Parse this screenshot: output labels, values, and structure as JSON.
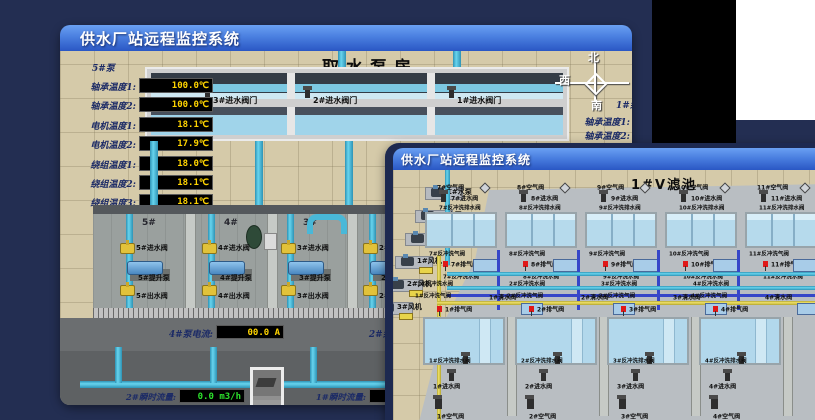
{
  "back_window": {
    "title": "供水厂站远程监控系统",
    "scene_title": "取水泵房",
    "left_panel": {
      "header": "5#泵",
      "rows": [
        {
          "label": "轴承温度1:",
          "value": "100.0℃"
        },
        {
          "label": "轴承温度2:",
          "value": "100.0℃"
        },
        {
          "label": "电机温度1:",
          "value": "18.1℃"
        },
        {
          "label": "电机温度2:",
          "value": "17.9℃"
        },
        {
          "label": "绕组温度1:",
          "value": "18.0℃"
        },
        {
          "label": "绕组温度2:",
          "value": "18.1℃"
        },
        {
          "label": "绕组温度3:",
          "value": "18.1℃"
        },
        {
          "label": "管道压力:",
          "value": "0.0007MPa"
        },
        {
          "label": "多功能阀:",
          "value": "0%"
        }
      ]
    },
    "intake_valves": [
      "3#进水阀门",
      "2#进水阀门",
      "1#进水阀门"
    ],
    "compass": {
      "north": "北",
      "west": "西",
      "south": "南"
    },
    "right_panel": {
      "header": "1#泵",
      "rows": [
        "轴承温度1:",
        "轴承温度2:"
      ]
    },
    "pump_bays": [
      {
        "bay": "5#",
        "inlet": "5#进水阀",
        "pump": "5#提升泵",
        "outlet": "5#出水阀"
      },
      {
        "bay": "4#",
        "inlet": "4#进水阀",
        "pump": "4#提升泵",
        "outlet": "4#出水阀"
      },
      {
        "bay": "3#",
        "inlet": "3#进水阀",
        "pump": "3#提升泵",
        "outlet": "3#出水阀"
      },
      {
        "bay": "2#",
        "inlet": "2#进水阀",
        "pump": "2#提升泵",
        "outlet": "2#出水阀"
      }
    ],
    "current_meters": [
      {
        "label": "4#泵电流:",
        "value": "00.0 A"
      },
      {
        "label": "2#泵电流:",
        "value": ""
      }
    ],
    "flow_meters": [
      {
        "label": "2#瞬时流量:",
        "value": "0.0 m3/h"
      },
      {
        "label": "1#瞬时流量:",
        "value": "0.0 m3/h"
      }
    ]
  },
  "front_window": {
    "title": "供水厂站远程监控系统",
    "scene_title": "1#V滤池",
    "equipment": [
      "1#水泵",
      "2#水泵",
      "3#水泵",
      "1#风机",
      "2#风机",
      "3#风机"
    ],
    "top_filters": [
      {
        "air": "7#空气阀",
        "inlet": "7#进水阀",
        "drain": "7#反冲洗排水阀",
        "bw_air": "7#反冲洗气阀",
        "exhaust": "7#排气阀",
        "bw_water": "7#反冲洗水阀"
      },
      {
        "air": "8#空气阀",
        "inlet": "8#进水阀",
        "drain": "8#反冲洗排水阀",
        "bw_air": "8#反冲洗气阀",
        "exhaust": "8#排气阀",
        "bw_water": "8#反冲洗水阀"
      },
      {
        "air": "9#空气阀",
        "inlet": "9#进水阀",
        "drain": "9#反冲洗排水阀",
        "bw_air": "9#反冲洗气阀",
        "exhaust": "9#排气阀",
        "bw_water": "9#反冲洗水阀"
      },
      {
        "air": "10#空气阀",
        "inlet": "10#进水阀",
        "drain": "10#反冲洗排水阀",
        "bw_air": "10#反冲洗气阀",
        "exhaust": "10#排气阀",
        "bw_water": "10#反冲洗水阀"
      },
      {
        "air": "11#空气阀",
        "inlet": "11#进水阀",
        "drain": "11#反冲洗排水阀",
        "bw_air": "11#反冲洗气阀",
        "exhaust": "11#排气阀",
        "bw_water": "11#反冲洗水阀"
      },
      {
        "air": "12#空气阀",
        "inlet": "12#进水阀",
        "drain": "12#反冲洗排水阀",
        "bw_air": "12#反冲洗气阀",
        "exhaust": "12#排气阀",
        "bw_water": "12#反冲洗水阀"
      }
    ],
    "bottom_filters": [
      {
        "bw_water": "1#反冲洗水阀",
        "bw_air": "1#反冲洗气阀",
        "exhaust": "1#排气阀",
        "clean": "1#清水阀",
        "drain": "1#反冲洗排水阀",
        "inlet": "1#进水阀",
        "air": "1#空气阀"
      },
      {
        "bw_water": "2#反冲洗水阀",
        "bw_air": "2#反冲洗气阀",
        "exhaust": "2#排气阀",
        "clean": "2#清水阀",
        "drain": "2#反冲洗排水阀",
        "inlet": "2#进水阀",
        "air": "2#空气阀"
      },
      {
        "bw_water": "3#反冲洗水阀",
        "bw_air": "3#反冲洗气阀",
        "exhaust": "3#排气阀",
        "clean": "3#清水阀",
        "drain": "3#反冲洗排水阀",
        "inlet": "3#进水阀",
        "air": "3#空气阀"
      },
      {
        "bw_water": "4#反冲洗水阀",
        "bw_air": "4#反冲洗气阀",
        "exhaust": "4#排气阀",
        "clean": "4#清水阀",
        "drain": "4#反冲洗排水阀",
        "inlet": "4#进水阀",
        "air": "4#空气阀"
      }
    ]
  },
  "colors": {
    "titlebar_top": "#6aa0f2",
    "titlebar_bottom": "#2a57c4",
    "backdrop": "#232e52",
    "led_yellow": "#ffd400",
    "led_green": "#2ce02c",
    "floor_tan": "#d5caa9",
    "water_blue": "#b6daec",
    "pipe_cyan": "#49c0e0",
    "pipe_yellow": "#e8d44a",
    "pipe_blue": "#3646c8",
    "valve_yellow": "#e2c23a",
    "alarm_red": "#e01818"
  }
}
